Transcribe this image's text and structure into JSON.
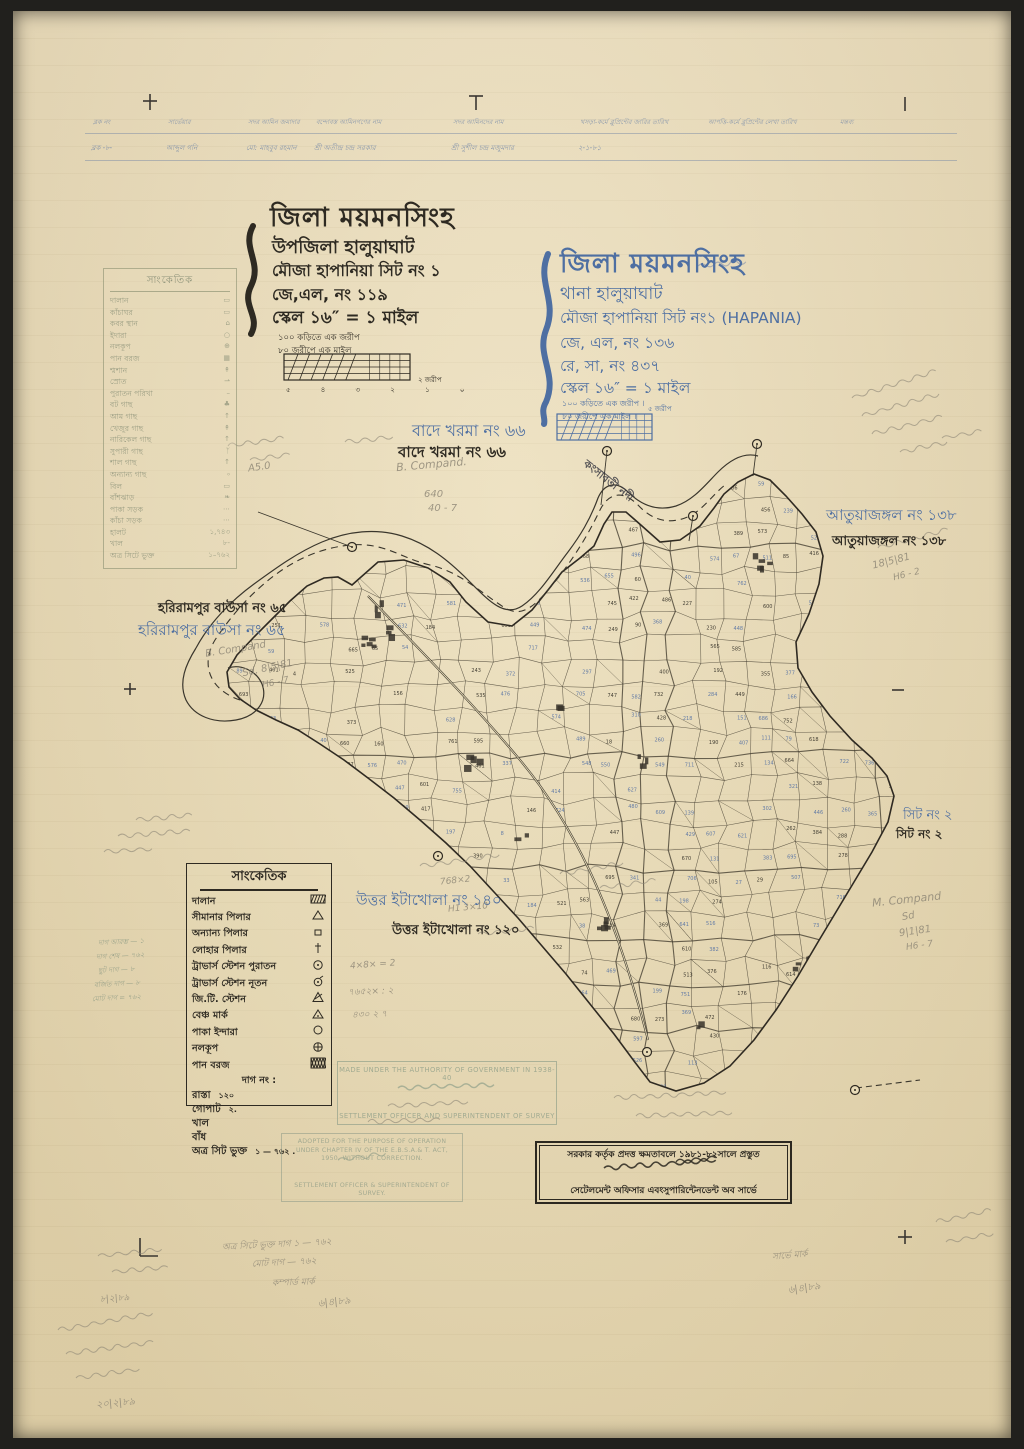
{
  "colors": {
    "paper": "#eadfbe",
    "ink_black": "#2e2a22",
    "ink_blue": "#4e6fa2",
    "pencil": "#8b8474",
    "faded_legend": "#8f947b",
    "stamp_green": "#9aa68e"
  },
  "header_table": {
    "columns": [
      {
        "header": "ব্লক নং",
        "entry": "ব্লক -৮-"
      },
      {
        "header": "সার্ভেয়ার",
        "entry": "আব্দুল গনি"
      },
      {
        "header": "সদর আমিন জমাদার",
        "entry": "মো: মাহবুব রহমান"
      },
      {
        "header": "বন্দোবস্ত আমিনগণের নাম",
        "entry": "শ্রী অতীন্দ্র চন্দ্র সরকার"
      },
      {
        "header": "সদর আমিনদের নাম",
        "entry": "শ্রী সুশীল চন্দ্র মজুমদার"
      },
      {
        "header": "খসড়া-কর্মে ব্লুপ্রিন্টের জারির তারিখ",
        "entry": "২-১-৮১"
      },
      {
        "header": "আপত্তি-কর্মে ব্লুপ্রিন্টের লেখা তারিখ",
        "entry": ""
      },
      {
        "header": "মন্তব্য",
        "entry": ""
      }
    ]
  },
  "title_block_black": {
    "district": "জিলা ময়মনসিংহ",
    "upazila": "উপজিলা হালুয়াঘাট",
    "mouza": "মৌজা হাপানিয়া সিট নং ১",
    "jl": "জে,এল, নং ১১৯",
    "scale": "স্কেল ১৬″ = ১ মাইল",
    "note1": "১০০ কড়িতে এক জরীপ",
    "note2": "৮০ জরীপে এক মাইল",
    "ticks": "৫ ৪ ৩ ২ ১ ০",
    "bar_unit": "২ জরীপ"
  },
  "title_block_blue": {
    "district": "জিলা ময়মনসিংহ",
    "thana": "থানা হালুয়াঘাট",
    "mouza": "মৌজা হাপানিয়া সিট নং১ (HAPANIA)",
    "jl": "জে, এল, নং ১৩৬",
    "rs": "রে, সা, নং ৪৩৭",
    "scale": "স্কেল ১৬″ = ১ মাইল",
    "note1": "১০০ কড়িতে এক জরীপ ।",
    "note2": "৮০ জরীপে এক মাইল ।",
    "bar_unit": "৫ জরীপ"
  },
  "legend_faded": {
    "title": "সাংকেতিক",
    "items": [
      {
        "label": "দালান",
        "sym": "▭"
      },
      {
        "label": "কাঁচাঘর",
        "sym": "▭"
      },
      {
        "label": "কবর স্থান",
        "sym": "⌂"
      },
      {
        "label": "ইদারা",
        "sym": "○"
      },
      {
        "label": "নলকূপ",
        "sym": "⊕"
      },
      {
        "label": "পান বরজ",
        "sym": "▦"
      },
      {
        "label": "শ্মশান",
        "sym": "↟"
      },
      {
        "label": "স্রোত",
        "sym": "⇀"
      },
      {
        "label": "পুরাতন পরিখা",
        "sym": "–"
      },
      {
        "label": "বট গাছ",
        "sym": "♣"
      },
      {
        "label": "আম গাছ",
        "sym": "↑"
      },
      {
        "label": "খেজুর গাছ",
        "sym": "↟"
      },
      {
        "label": "নারিকেল গাছ",
        "sym": "↑"
      },
      {
        "label": "সুপারী গাছ",
        "sym": "ᛉ"
      },
      {
        "label": "শাল গাছ",
        "sym": "↑"
      },
      {
        "label": "অন্যান্য গাছ",
        "sym": "৹"
      },
      {
        "label": "বিল",
        "sym": "▭"
      },
      {
        "label": "বাঁশঝাড়",
        "sym": "❧"
      },
      {
        "label": "পাকা সড়ক",
        "sym": "⋯"
      },
      {
        "label": "কাঁচা সড়ক",
        "sym": "⋯"
      },
      {
        "label": "হালট",
        "sym": "১,৭৪৩"
      },
      {
        "label": "খাল",
        "sym": "৮-"
      },
      {
        "label": "অত্র সিটে ভুক্ত",
        "sym": "১–৭৬২"
      }
    ]
  },
  "legend_main": {
    "title": "সাংকেতিক",
    "items": [
      {
        "label": "দালান",
        "sym": "hatch"
      },
      {
        "label": "সীমানার পিলার",
        "sym": "tri"
      },
      {
        "label": "অন্যান্য পিলার",
        "sym": "sq"
      },
      {
        "label": "লোহার পিলার",
        "sym": "dagger"
      },
      {
        "label": "ট্রাভার্স স্টেশন পুরাতন",
        "sym": "circdot"
      },
      {
        "label": "ট্রাভার্স স্টেশন নূতন",
        "sym": "circtail"
      },
      {
        "label": "জি.টি. স্টেশন",
        "sym": "gtri"
      },
      {
        "label": "বেঞ্চ মার্ক",
        "sym": "btri"
      },
      {
        "label": "পাকা ইন্দারা",
        "sym": "circ"
      },
      {
        "label": "নলকূপ",
        "sym": "circplus"
      },
      {
        "label": "পান বরজ",
        "sym": "xhatch"
      }
    ],
    "dag_label": "দাগ নং :",
    "extras": [
      {
        "label": "রাস্তা",
        "value": "১২০"
      },
      {
        "label": "গোপাট",
        "value": "২."
      },
      {
        "label": "খাল",
        "value": ""
      },
      {
        "label": "বাঁধ",
        "value": ""
      },
      {
        "label": "অত্র সিট ভুক্ত",
        "value": "১ — ৭৬২ ."
      }
    ]
  },
  "map": {
    "river_label": "কংসাবতী নদী",
    "labels": [
      {
        "id": "bade-kharma-blue",
        "text": "বাদে খরমা নং ৬৬",
        "color": "blue",
        "x": 412,
        "y": 418,
        "size": 16,
        "bold": false
      },
      {
        "id": "bade-kharma-black",
        "text": "বাদে খরমা নং ৬৬",
        "color": "black",
        "x": 398,
        "y": 441,
        "size": 15,
        "bold": true
      },
      {
        "id": "harirampur-black",
        "text": "হরিরামপুর বাউসা নং ৬৫",
        "color": "black",
        "x": 158,
        "y": 599,
        "size": 13,
        "bold": true
      },
      {
        "id": "harirampur-blue",
        "text": "হরিরামপুর বাউসা নং ৬৫",
        "color": "blue",
        "x": 138,
        "y": 619,
        "size": 15,
        "bold": false
      },
      {
        "id": "atuajangal-blue",
        "text": "আতুয়াজঙ্গল নং ১৩৮",
        "color": "blue",
        "x": 826,
        "y": 504,
        "size": 15,
        "bold": false
      },
      {
        "id": "atuajangal-black",
        "text": "আতুয়াজঙ্গল নং ১৩৮",
        "color": "black",
        "x": 832,
        "y": 532,
        "size": 13,
        "bold": true
      },
      {
        "id": "sheet2-blue",
        "text": "সিট নং ২",
        "color": "blue",
        "x": 903,
        "y": 806,
        "size": 13,
        "bold": false
      },
      {
        "id": "sheet2-black",
        "text": "সিট নং ২",
        "color": "black",
        "x": 896,
        "y": 826,
        "size": 12,
        "bold": true
      },
      {
        "id": "itakhola-blue",
        "text": "উত্তর ইটাখোলা নং ১৪০",
        "color": "blue",
        "x": 356,
        "y": 889,
        "size": 15,
        "bold": false
      },
      {
        "id": "itakhola-black",
        "text": "উত্তর ইটাখোলা নং ১২০",
        "color": "black",
        "x": 392,
        "y": 921,
        "size": 13,
        "bold": true
      }
    ]
  },
  "stamps": {
    "authority": {
      "line1": "MADE UNDER THE AUTHORITY OF GOVERNMENT IN 1938-40",
      "line2": "SETTLEMENT OFFICER AND SUPERINTENDENT OF SURVEY"
    },
    "adopted": {
      "line1": "ADOPTED FOR THE PURPOSE OF OPERATION",
      "line2": "UNDER CHAPTER IV OF THE E.B.S.A.& T. ACT,",
      "line3": "1950, WITHOUT CORRECTION.",
      "line4": "SETTLEMENT OFFICER & SUPERINTENDENT OF",
      "line5": "SURVEY."
    },
    "bengali": {
      "line1": "সরকার কর্তৃক প্রদত্ত ক্ষমতাবলে ১৯৮১-৮২সালে প্রস্তুত",
      "line2": "সেটেলমেন্ট অফিসার এবংসুপারিন্টেনডেন্ট অব সার্ভে"
    }
  },
  "pencil_notes": [
    {
      "text": "B. Compand.",
      "x": 396,
      "y": 458,
      "rot": -5,
      "size": 11
    },
    {
      "text": "A5.0",
      "x": 248,
      "y": 462,
      "rot": -8,
      "size": 10
    },
    {
      "text": "640",
      "x": 424,
      "y": 489,
      "rot": 0,
      "size": 10
    },
    {
      "text": "40 - 7",
      "x": 428,
      "y": 503,
      "rot": 0,
      "size": 10
    },
    {
      "text": "B. Compand",
      "x": 205,
      "y": 644,
      "rot": -9,
      "size": 10
    },
    {
      "text": "Sd.  8|5|81",
      "x": 242,
      "y": 663,
      "rot": -12,
      "size": 10
    },
    {
      "text": "H6 - 7",
      "x": 262,
      "y": 678,
      "rot": -12,
      "size": 9
    },
    {
      "text": "18|5|81",
      "x": 872,
      "y": 556,
      "rot": -14,
      "size": 10
    },
    {
      "text": "H6 - 2",
      "x": 893,
      "y": 570,
      "rot": -14,
      "size": 9
    },
    {
      "text": "M. Compand",
      "x": 872,
      "y": 893,
      "rot": -6,
      "size": 11
    },
    {
      "text": "Sd",
      "x": 902,
      "y": 911,
      "rot": -10,
      "size": 10
    },
    {
      "text": "9|1|81",
      "x": 899,
      "y": 926,
      "rot": -8,
      "size": 10
    },
    {
      "text": "H6 - 7",
      "x": 906,
      "y": 941,
      "rot": -8,
      "size": 9
    },
    {
      "text": "দাগ আরম্ভ — ১",
      "x": 98,
      "y": 936,
      "rot": -3,
      "size": 7,
      "green": true
    },
    {
      "text": "দাগ শেষ — ৭৬২",
      "x": 96,
      "y": 950,
      "rot": -3,
      "size": 7,
      "green": true
    },
    {
      "text": "ছুট দাগ — ৮",
      "x": 98,
      "y": 964,
      "rot": -3,
      "size": 7,
      "green": true
    },
    {
      "text": "বর্জিত দাগ — ৮",
      "x": 94,
      "y": 978,
      "rot": -3,
      "size": 7,
      "green": true
    },
    {
      "text": "মোট দাগ = ৭৬২",
      "x": 92,
      "y": 992,
      "rot": -3,
      "size": 7,
      "green": true
    },
    {
      "text": "768×2",
      "x": 440,
      "y": 876,
      "rot": -6,
      "size": 9
    },
    {
      "text": "H1 3×10",
      "x": 448,
      "y": 903,
      "rot": -5,
      "size": 9
    },
    {
      "text": "4×8× = 2",
      "x": 350,
      "y": 960,
      "rot": -4,
      "size": 9
    },
    {
      "text": "৭৬৫২× : ২",
      "x": 348,
      "y": 984,
      "rot": -2,
      "size": 9
    },
    {
      "text": "৪৩০ ২ ৭",
      "x": 352,
      "y": 1007,
      "rot": -2,
      "size": 9
    },
    {
      "text": "অত্র সিটে ভুক্ত দাগ ১ — ৭৬২",
      "x": 222,
      "y": 1237,
      "rot": -3,
      "size": 9
    },
    {
      "text": "মোট দাগ — ৭৬২",
      "x": 252,
      "y": 1255,
      "rot": -3,
      "size": 9
    },
    {
      "text": "কম্পার্ড মার্ক",
      "x": 272,
      "y": 1275,
      "rot": -2,
      "size": 9
    },
    {
      "text": "৬|৪|৮৯",
      "x": 318,
      "y": 1295,
      "rot": -6,
      "size": 10
    },
    {
      "text": "সার্ভে মার্ক",
      "x": 772,
      "y": 1248,
      "rot": -5,
      "size": 9
    },
    {
      "text": "৬|৪|৮৯",
      "x": 788,
      "y": 1281,
      "rot": -8,
      "size": 10
    },
    {
      "text": "৮|২|৮৯",
      "x": 100,
      "y": 1291,
      "rot": -4,
      "size": 9
    },
    {
      "text": "২০|২|৮৯",
      "x": 96,
      "y": 1396,
      "rot": -5,
      "size": 10
    }
  ]
}
